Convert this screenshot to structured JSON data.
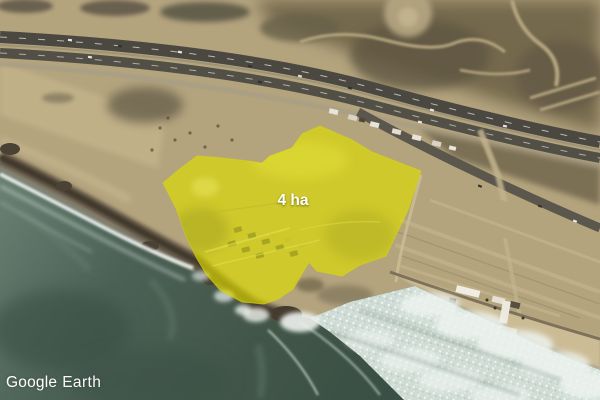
{
  "app": {
    "watermark": {
      "brand": "Google",
      "product": "Earth"
    }
  },
  "overlay": {
    "area_label": "4 ha",
    "area_value_ha": 4,
    "polygon_points": "320,126 352,140 372,152 421,171 408,210 386,256 360,265 342,276 317,271 309,262 293,289 278,299 264,304 242,302 220,290 206,274 196,257 186,236 176,208 163,183 181,168 197,156 222,158 248,161 262,163 270,156 292,148 302,134",
    "fill_color": "#dedc00",
    "fill_opacity": "0.66",
    "outline_color": "#ededt2e",
    "label_color": "#ffffff"
  },
  "scene": {
    "colors": {
      "terrain_tan": "#b4a47e",
      "scrubland_dark": "#6f6549",
      "highway_asphalt": "#4a4841",
      "ocean_deep": "#3a4f45",
      "ocean_near_shore": "#6a8174",
      "surf_foam": "#e8efeb",
      "beach_sand": "#cbbc96",
      "cliff_dark": "#564c3c"
    }
  }
}
